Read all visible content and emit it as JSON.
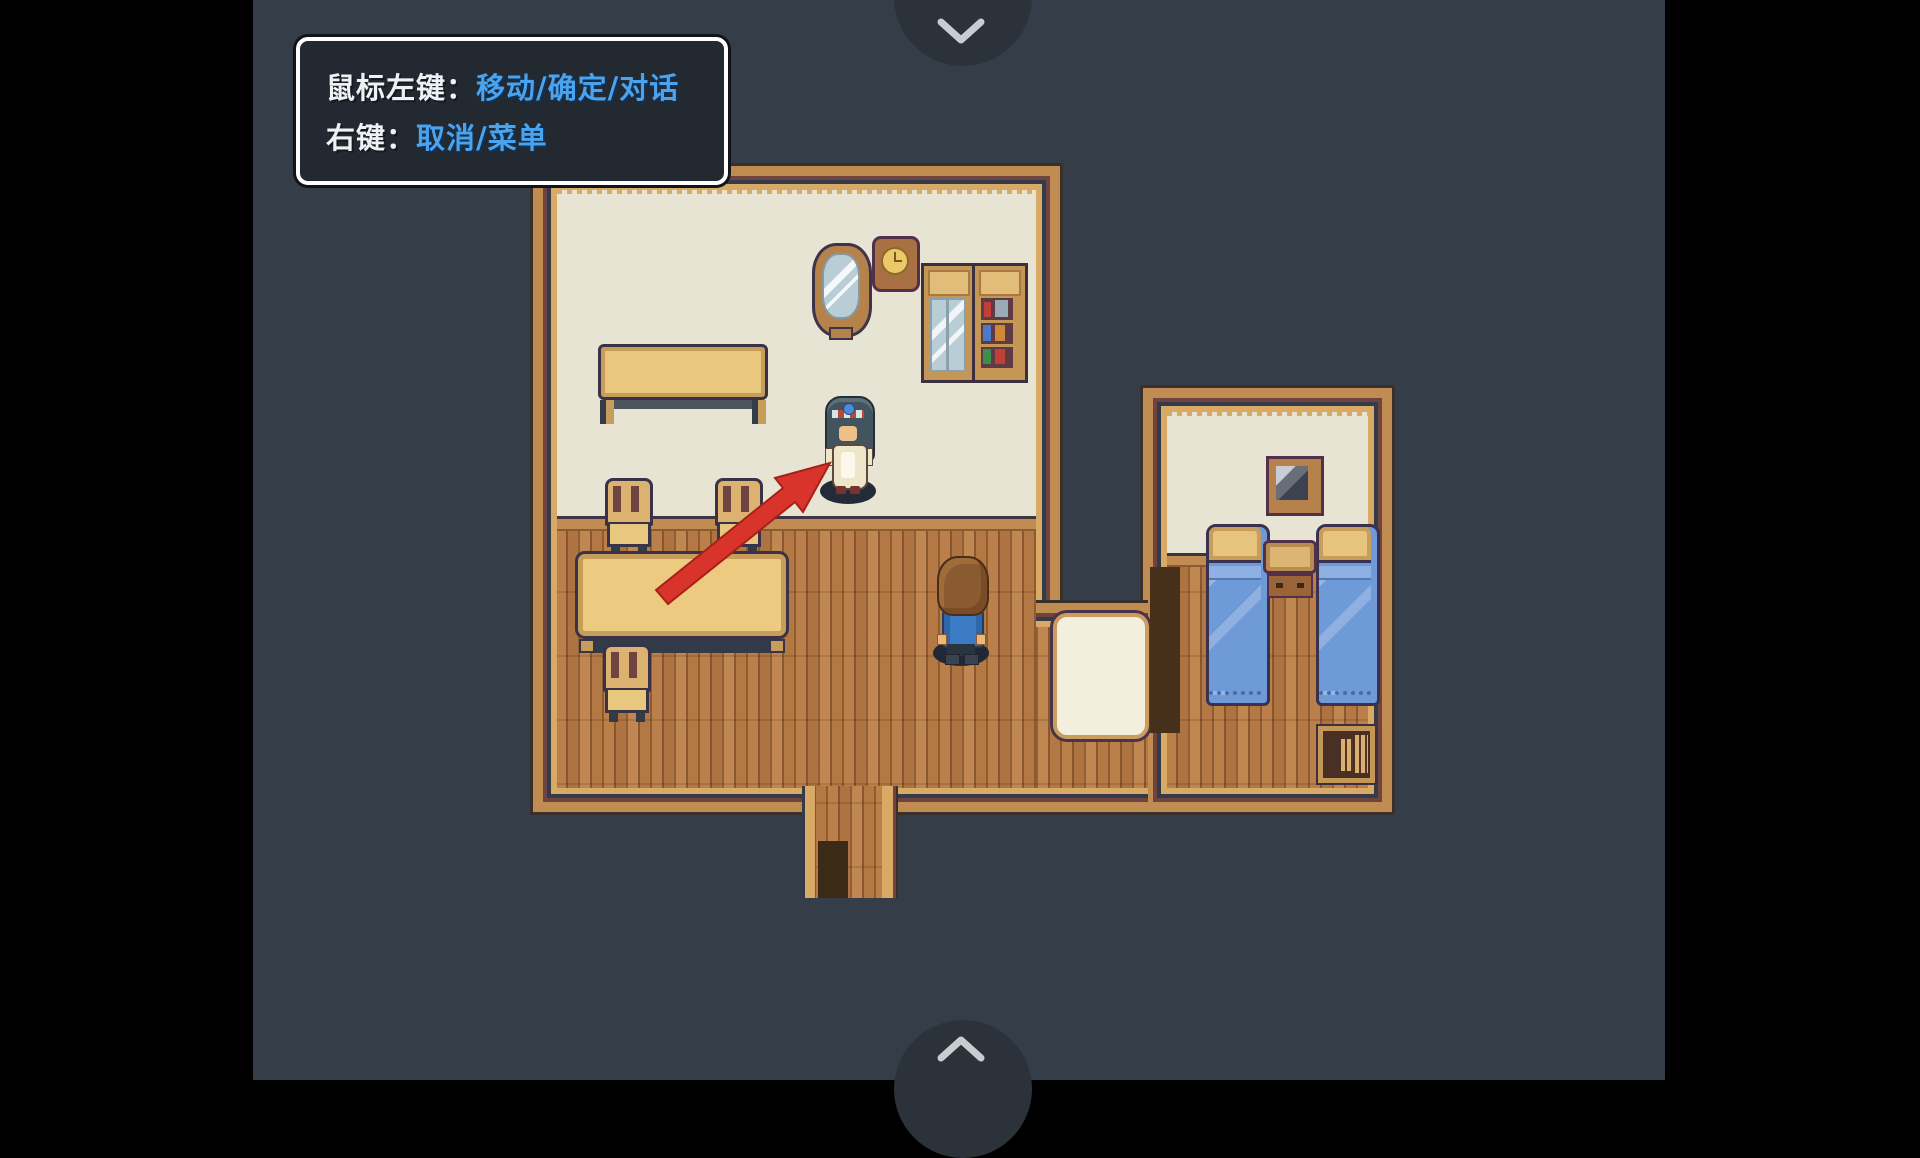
{
  "letterbox": {
    "color": "#000000"
  },
  "stage": {
    "background": "#353e48"
  },
  "nav": {
    "top_button": {
      "icon": "chevron-down-icon",
      "circle_color": "#2c323a",
      "glyph_color": "#c9cdd1"
    },
    "bottom_button": {
      "icon": "chevron-up-icon",
      "circle_color": "#2c323a",
      "glyph_color": "#c9cdd1"
    }
  },
  "tooltip": {
    "lines": [
      {
        "label": "鼠标左键：",
        "value": "移动/确定/对话"
      },
      {
        "label": "右键：",
        "value": "取消/菜单"
      }
    ],
    "label_color": "#eef2f4",
    "value_color": "#4aa3ef",
    "background": "#232931",
    "border_color": "#ffffff"
  },
  "scene": {
    "description": "Top-down pixel-art house interior: living room with tables and chairs, bedroom with two beds, maid NPC indicated by red arrow, player character facing away",
    "palette": {
      "wall_wood": "#c18c52",
      "wall_trim_gold": "#d9a966",
      "wall_trim_maroon": "#6f4340",
      "wall_trim_navy": "#333b49",
      "wall_cream": "#e7e4d4",
      "floor_wood": "#b87c45",
      "doormat_cream": "#f4efdd",
      "bed_blanket_blue": "#6f9ad8",
      "furniture_wood": "#e8c77f",
      "arrow_red": "#d8342b"
    },
    "entities": {
      "npc": "maid-npc",
      "player": "player-character",
      "arrow_target": "maid-npc"
    }
  }
}
